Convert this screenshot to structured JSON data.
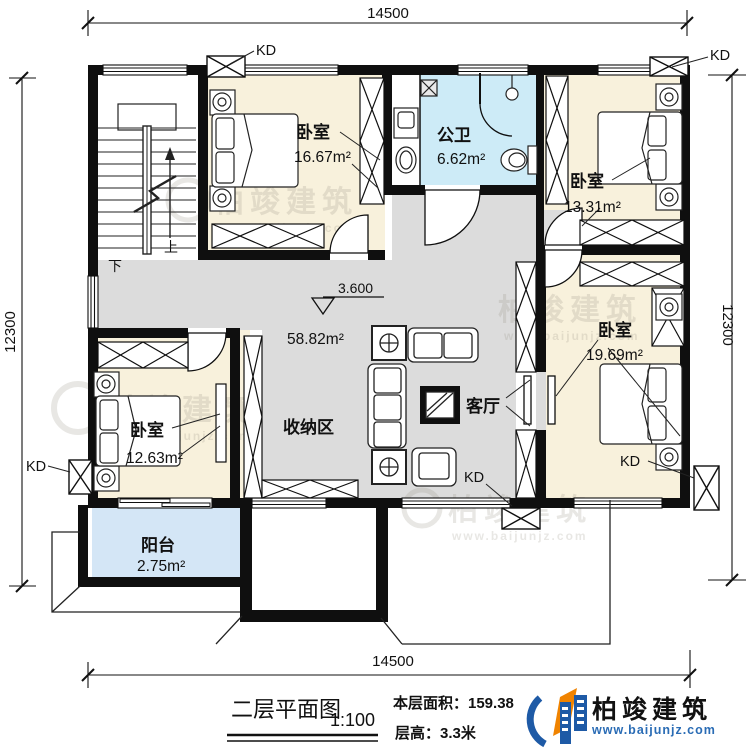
{
  "drawing": {
    "dim_top": "14500",
    "dim_bottom": "14500",
    "dim_left": "12300",
    "dim_right": "12300",
    "level": "3.600",
    "kd": "KD",
    "stair_up": "上",
    "stair_down": "下",
    "rooms": {
      "bedroom_a": {
        "name": "卧室",
        "area": "16.67m²"
      },
      "bathroom": {
        "name": "公卫",
        "area": "6.62m²"
      },
      "bedroom_b": {
        "name": "卧室",
        "area": "13.31m²"
      },
      "bedroom_c": {
        "name": "卧室",
        "area": "19.69m²"
      },
      "bedroom_d": {
        "name": "卧室",
        "area": "12.63m²"
      },
      "balcony": {
        "name": "阳台",
        "area": "2.75m²"
      },
      "storage": {
        "name": "收纳区"
      },
      "living": {
        "name": "客厅"
      },
      "hall_area": "58.82m²"
    }
  },
  "watermark": {
    "brand": "柏竣建筑",
    "url": "www.baijunjz.com"
  },
  "title_block": {
    "title": "二层平面图",
    "scale": "1:100",
    "floor_area_label": "本层面积：159.38",
    "floor_height_label": "层高：3.3米",
    "brand": "柏竣建筑",
    "brand_url": "www.baijunjz.com"
  },
  "colors": {
    "wall": "#0f0f0f",
    "bedroom_fill": "#f8f1dc",
    "bathroom_fill": "#cdebf7",
    "balcony_fill": "#d4e6f6",
    "hall_fill": "#dcdcdc",
    "logo_blue": "#1e5aa6",
    "logo_orange": "#f08300",
    "url_blue": "#2a6cb5"
  }
}
